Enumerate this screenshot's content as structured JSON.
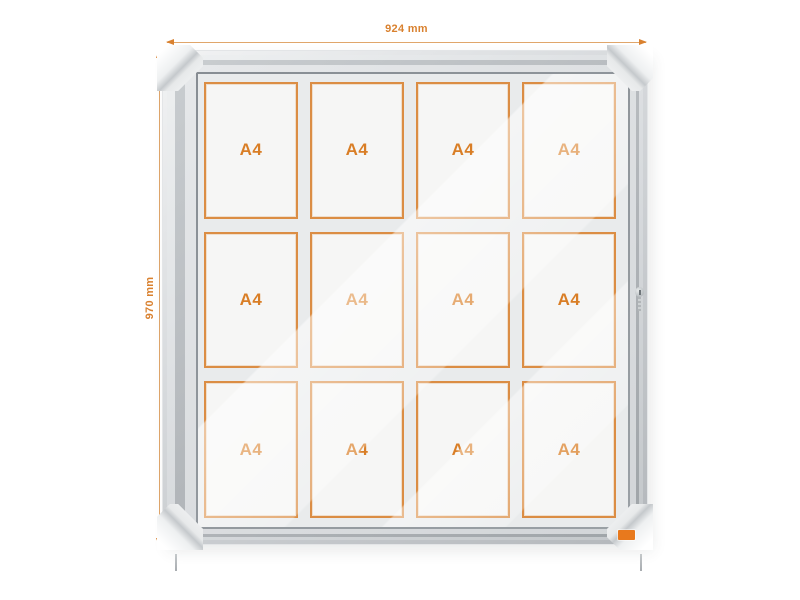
{
  "dimensions": {
    "width_label": "924 mm",
    "height_label": "970 mm"
  },
  "board": {
    "rows": 3,
    "columns": 4,
    "cells": [
      {
        "label": "A4"
      },
      {
        "label": "A4"
      },
      {
        "label": "A4"
      },
      {
        "label": "A4"
      },
      {
        "label": "A4"
      },
      {
        "label": "A4"
      },
      {
        "label": "A4"
      },
      {
        "label": "A4"
      },
      {
        "label": "A4"
      },
      {
        "label": "A4"
      },
      {
        "label": "A4"
      },
      {
        "label": "A4"
      }
    ]
  },
  "icons": {
    "lock": "cylinder-lock-icon",
    "corner_caps": "protective-corner-caps"
  },
  "colors": {
    "accent_orange": "#d9812f",
    "cell_border_orange": "#db8d44",
    "brand_chip_orange": "#e8791d",
    "frame_silver": "#c9cdd0",
    "glass_grey": "#e9ebec"
  }
}
